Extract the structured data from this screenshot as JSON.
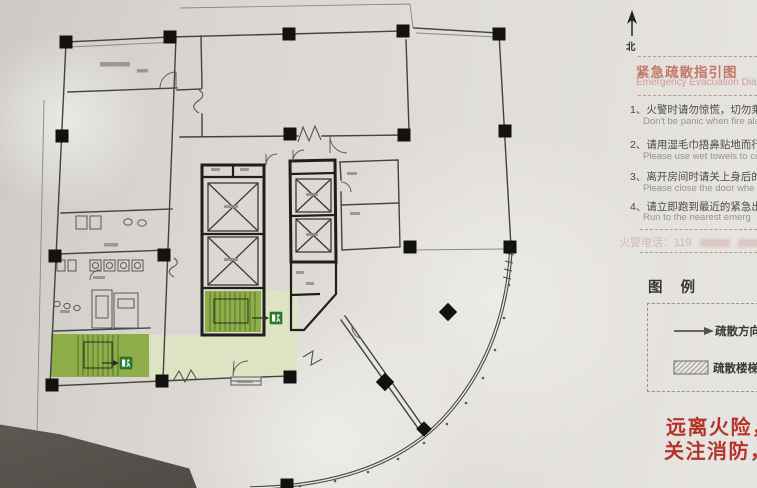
{
  "colors": {
    "red_slogan": "#b5342a",
    "red_title": "#c4766b",
    "green_stair": "#8fae4a",
    "green_lobby": "#dde4c4",
    "green_exit": "#2f7d33",
    "paper": "#dcd9d4"
  },
  "north_label": "北",
  "panel": {
    "title_cn": "紧急疏散指引图",
    "title_en": "Emergency Evacuation Dia",
    "instructions": [
      {
        "cn": "1、火警时请勿惊慌，切勿乘搭电",
        "en": "Don't be panic when fire alarm"
      },
      {
        "cn": "2、请用湿毛巾捂鼻贴地而行。",
        "en": "Please use wet towels to co"
      },
      {
        "cn": "3、离开房间时请关上身后的门",
        "en": "Please close the door whe"
      },
      {
        "cn": "4、请立即跑到最近的紧急出口",
        "en": "Run to the nearest emerg"
      }
    ],
    "hotline": "火警电话：119",
    "legend_heading": "图 例",
    "legend_items": [
      {
        "label": "疏散方向"
      },
      {
        "label": "疏散楼梯"
      }
    ],
    "slogan_line1": "远离火险，珍",
    "slogan_line2": "关注消防，排"
  }
}
